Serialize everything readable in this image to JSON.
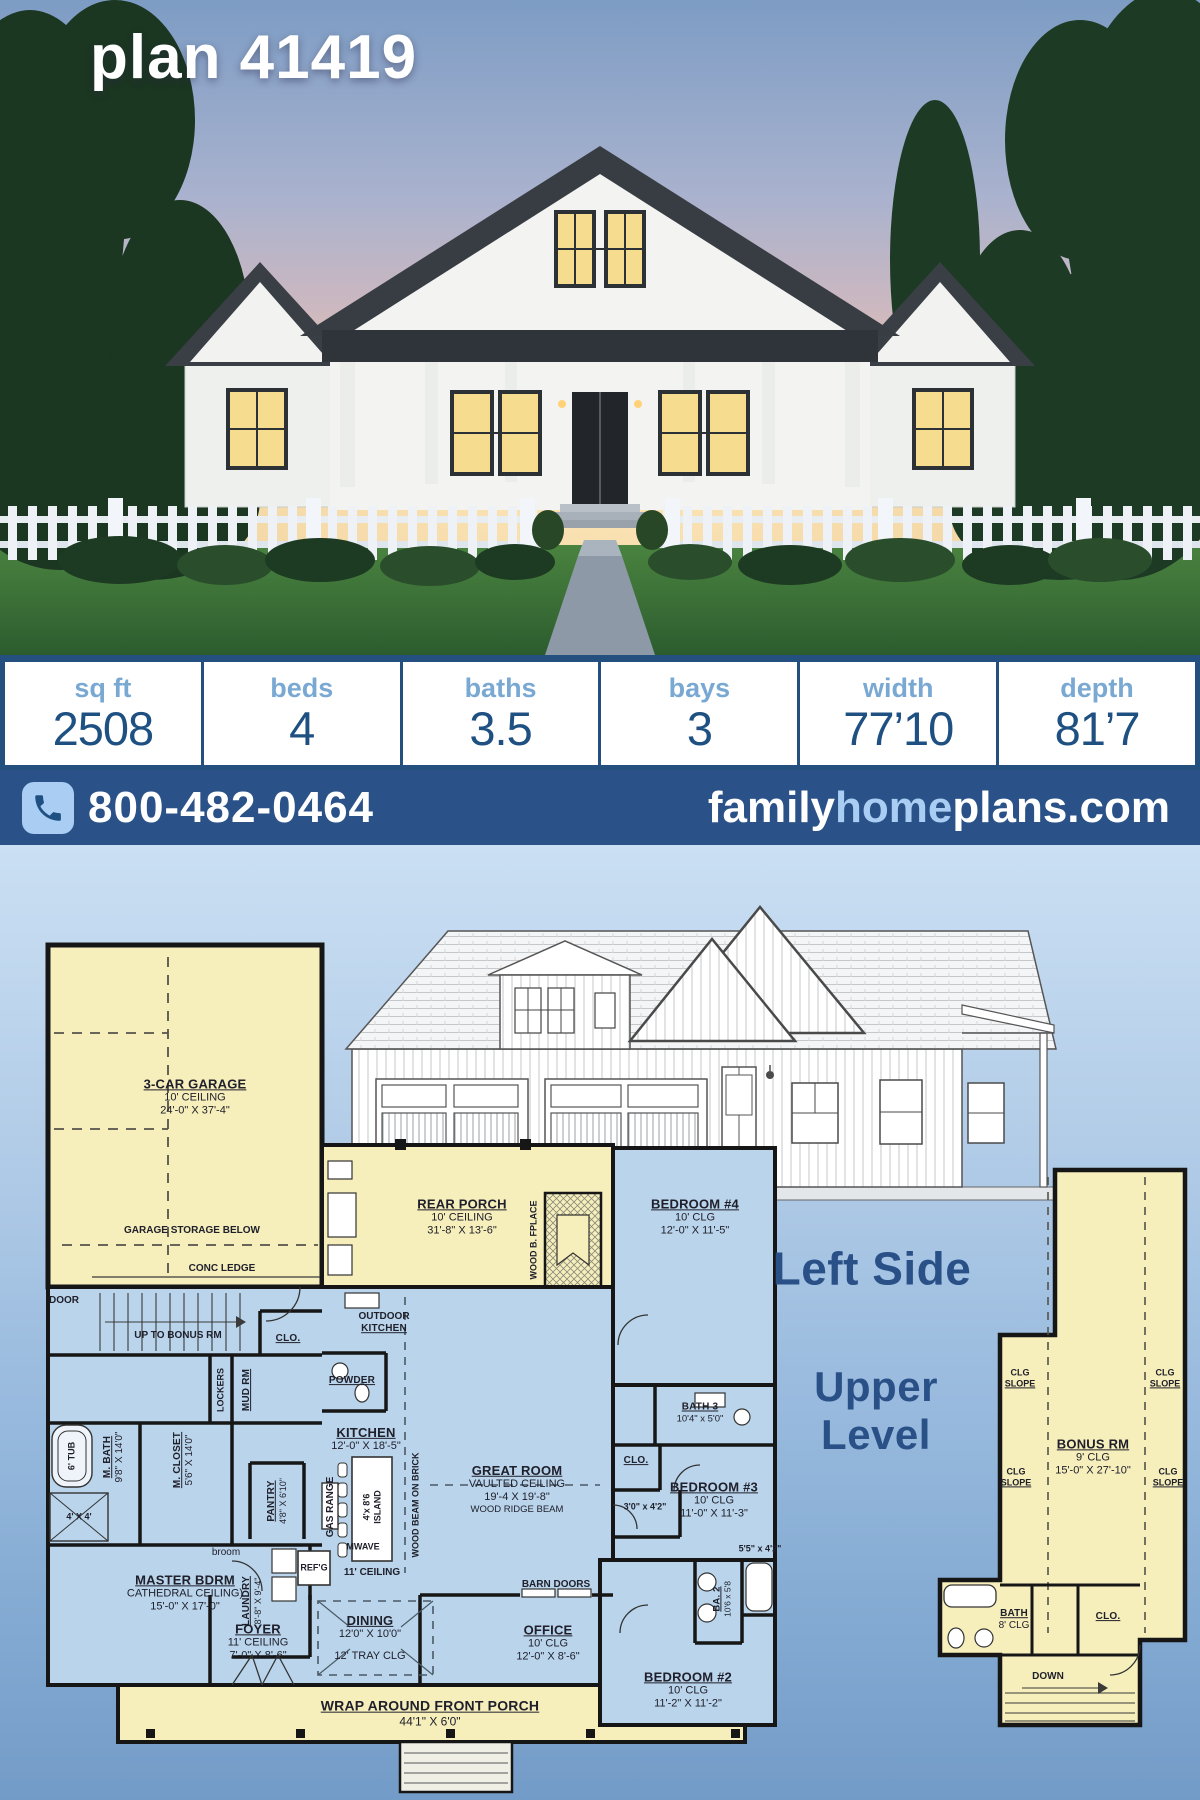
{
  "title": "plan 41419",
  "stats": {
    "items": [
      {
        "label": "sq ft",
        "value": "2508"
      },
      {
        "label": "beds",
        "value": "4"
      },
      {
        "label": "baths",
        "value": "3.5"
      },
      {
        "label": "bays",
        "value": "3"
      },
      {
        "label": "width",
        "value": "77’10"
      },
      {
        "label": "depth",
        "value": "81’7"
      }
    ]
  },
  "contact": {
    "phone": "800-482-0464",
    "site_left": "family",
    "site_mid": "home",
    "site_right": "plans.com"
  },
  "sections": {
    "left_side": "Left Side",
    "upper_line1": "Upper",
    "upper_line2": "Level"
  },
  "colors": {
    "bar_blue": "#2a5288",
    "light_blue": "#a9cdf3",
    "stat_value_blue": "#1f5082",
    "stat_label_blue": "#79a9d3",
    "plan_yellow": "#f6efbc",
    "plan_blue": "#bad5eb"
  },
  "main_floor": {
    "garage": {
      "n": "3-CAR GARAGE",
      "l2": "10' CEILING",
      "l3": "24'-0\" X 37'-4\""
    },
    "storage": {
      "t": "GARAGE STORAGE BELOW"
    },
    "conc_ledge": {
      "t": "CONC LEDGE"
    },
    "door": {
      "t": "DOOR"
    },
    "up_bonus": {
      "t": "UP TO BONUS RM"
    },
    "clo1": {
      "t": "CLO."
    },
    "outdoor_kitchen": {
      "l1": "OUTDOOR",
      "l2": "KITCHEN"
    },
    "powder": {
      "t": "POWDER"
    },
    "rear_porch": {
      "n": "REAR PORCH",
      "l2": "10' CEILING",
      "l3": "31'-8\" X 13'-6\""
    },
    "fplace": {
      "t": "WOOD B. FPLACE"
    },
    "bed4": {
      "n": "BEDROOM #4",
      "l2": "10' CLG",
      "l3": "12'-0\" X 11'-5\""
    },
    "bath3": {
      "n": "BATH 3",
      "l2": "10'4\" x 5'0\""
    },
    "mbath": {
      "n": "M. BATH",
      "l2": "9'8\" X 14'0\""
    },
    "tub": {
      "t": "6' TUB"
    },
    "mcloset": {
      "n": "M. CLOSET",
      "l2": "5'6\" X 14'0\""
    },
    "lockers": {
      "t": "LOCKERS"
    },
    "mudrm": {
      "t": "MUD RM"
    },
    "shower": {
      "t": "4' X 4'"
    },
    "kitchen": {
      "n": "KITCHEN",
      "l2": "12'-0\" X 18'-5\""
    },
    "pantry": {
      "n": "PANTRY",
      "l2": "4'8\" X 6'10\""
    },
    "gas_range": {
      "t": "GAS RANGE"
    },
    "island": {
      "l1": "4'x 8'6",
      "l2": "ISLAND"
    },
    "mwave": {
      "t": "MWAVE"
    },
    "refg": {
      "t": "REF'G"
    },
    "ceiling11": {
      "t": "11' CEILING"
    },
    "broom": {
      "t": "broom"
    },
    "wood_beam": {
      "t": "WOOD BEAM ON BRICK"
    },
    "great_room": {
      "n": "GREAT ROOM",
      "l2": "VAULTED CEILING",
      "l3": "19'-4 X 19'-8\"",
      "l4": "WOOD RIDGE BEAM"
    },
    "clo2": {
      "t": "CLO."
    },
    "closet3": {
      "t": "3'0\" x 4'2\""
    },
    "bed3": {
      "n": "BEDROOM #3",
      "l2": "10' CLG",
      "l3": "11'-0\" X 11'-3\""
    },
    "master": {
      "n": "MASTER BDRM",
      "l2": "CATHEDRAL CEILING)",
      "l3": "15'-0\" X 17'-0\""
    },
    "laundry": {
      "n": "LAUNDRY",
      "l2": "8'-8\" X 9'-4\""
    },
    "dining": {
      "n": "DINING",
      "l2": "12'0\" X 10'0\"",
      "l3": "12' TRAY CLG"
    },
    "foyer": {
      "n": "FOYER",
      "l2": "11' CEILING",
      "l3": "7'-0\" X 8'-6\""
    },
    "barn_doors": {
      "t": "BARN DOORS"
    },
    "office": {
      "n": "OFFICE",
      "l2": "10' CLG",
      "l3": "12'-0\" X 8'-6\""
    },
    "ba2": {
      "l1": "BA. 2",
      "l2": "10'6 x 5'8"
    },
    "bath2_dim": {
      "t": "5'5\" x 4'2\""
    },
    "bed2": {
      "n": "BEDROOM #2",
      "l2": "10' CLG",
      "l3": "11'-2\" X 11'-2\""
    },
    "front_porch": {
      "n": "WRAP AROUND FRONT PORCH",
      "l2": "44'1\" X 6'0\""
    }
  },
  "upper_floor": {
    "clg_slope": {
      "l1": "CLG",
      "l2": "SLOPE"
    },
    "bonus": {
      "n": "BONUS RM",
      "l2": "9' CLG",
      "l3": "15'-0\" X 27'-10\""
    },
    "bath": {
      "n": "BATH",
      "l2": "8' CLG"
    },
    "clo": {
      "t": "CLO."
    },
    "down": {
      "t": "DOWN"
    }
  }
}
